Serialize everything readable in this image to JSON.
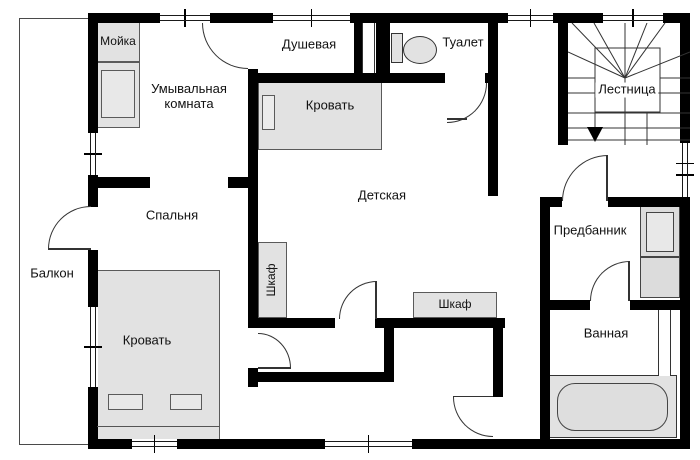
{
  "plan": {
    "labels": {
      "sink": "Мойка",
      "washroom": "Умывальная комната",
      "shower": "Душевая",
      "toilet": "Туалет",
      "nursery": "Детская",
      "nursery_bed": "Кровать",
      "stairs": "Лестница",
      "bedroom": "Спальня",
      "balcony": "Балкон",
      "wardrobe_side": "Шкаф",
      "wardrobe_bottom": "Шкаф",
      "anteroom": "Предбанник",
      "bedroom_bed": "Кровать",
      "bathroom": "Ванная"
    },
    "colors": {
      "wall": "#000000",
      "furniture_fill": "#e2e2e2",
      "line": "#333333",
      "floor": "#ffffff"
    }
  }
}
